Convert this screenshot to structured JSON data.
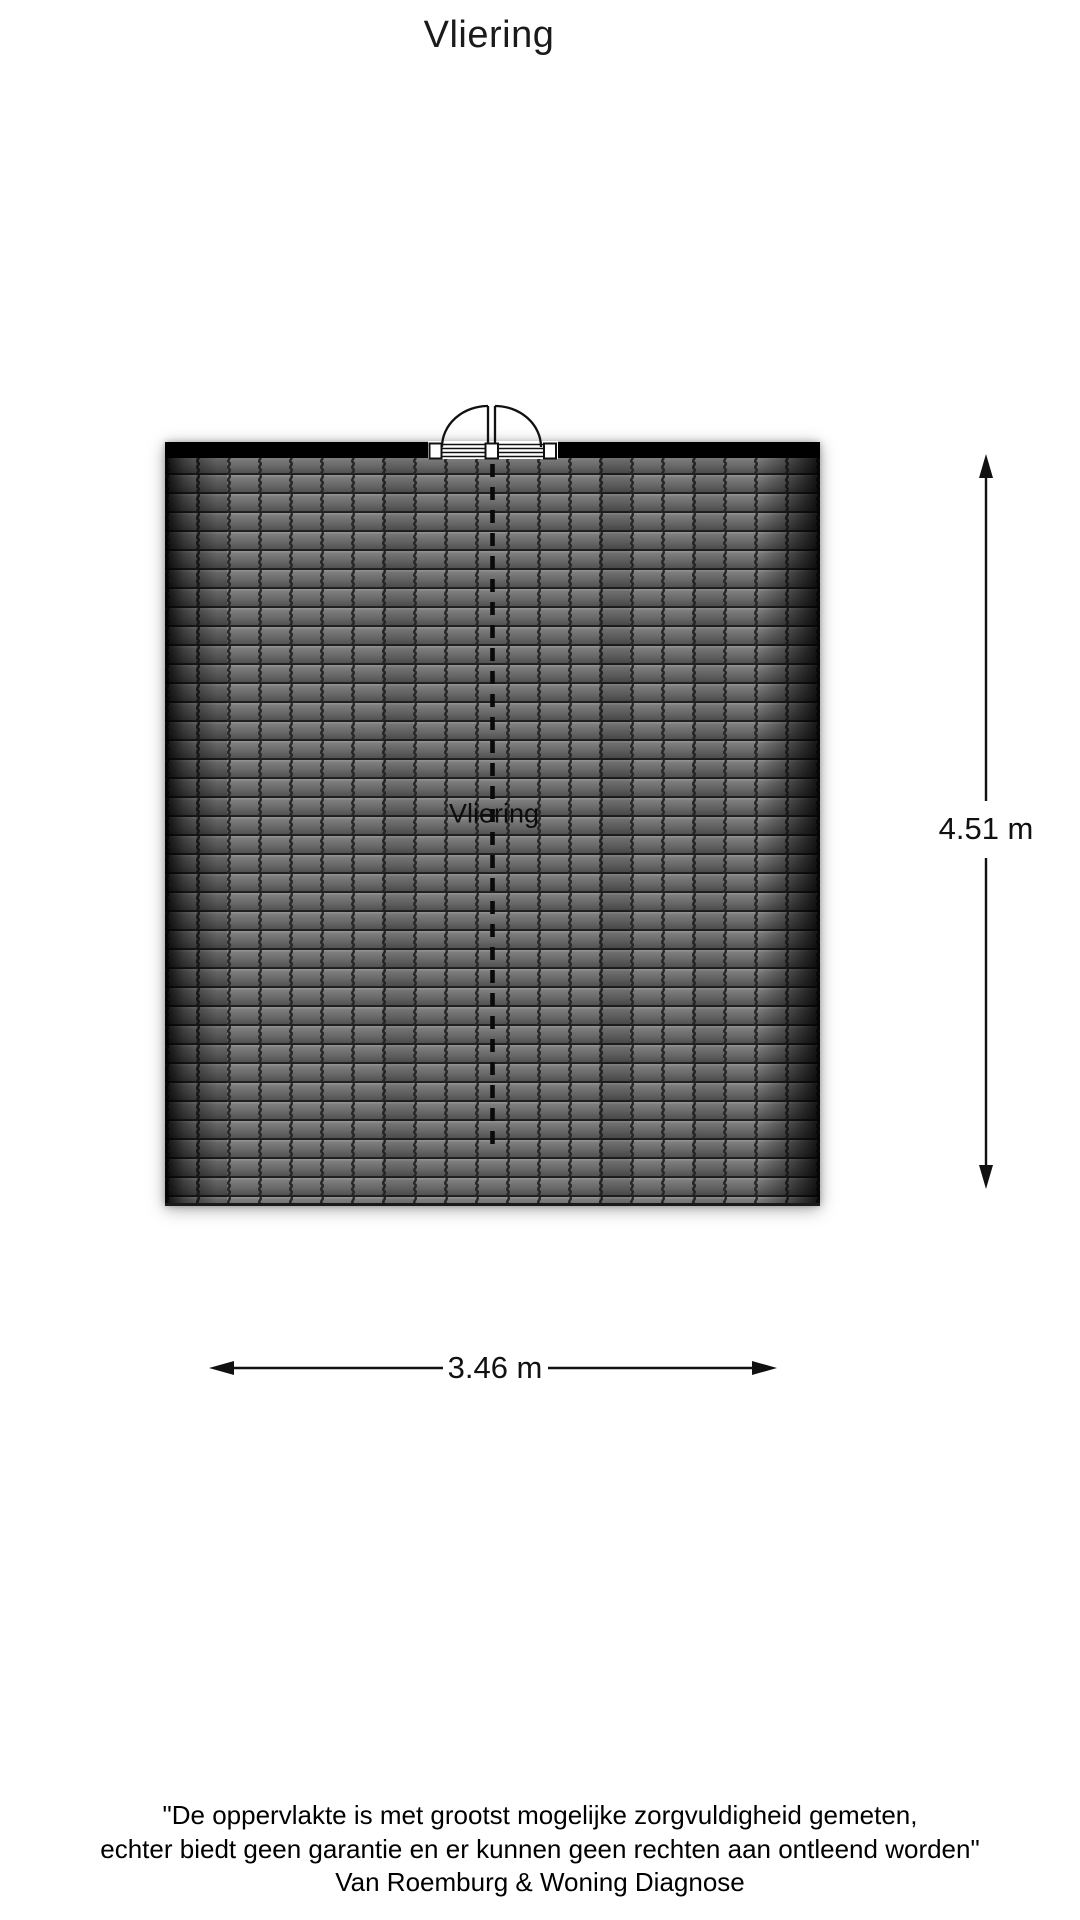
{
  "page_title": "Vliering",
  "plan": {
    "room_label": "Vliering",
    "height_dimension_label": "4.51 m",
    "width_dimension_label": "3.46 m"
  },
  "footer": {
    "line1": "\"De oppervlakte is met grootst mogelijke zorgvuldigheid gemeten,",
    "line2": "echter biedt geen garantie en er kunnen geen rechten aan ontleend worden\"",
    "line3": "Van Roemburg & Woning Diagnose"
  },
  "colors": {
    "wall": "#000000",
    "tile_highlight": "#8d8d8d",
    "tile_light": "#7e7e7e",
    "tile_mid": "#676767",
    "tile_dark": "#484848",
    "tile_joint": "#262626",
    "dimension_line": "#111111",
    "text": "#1a1a1a"
  }
}
